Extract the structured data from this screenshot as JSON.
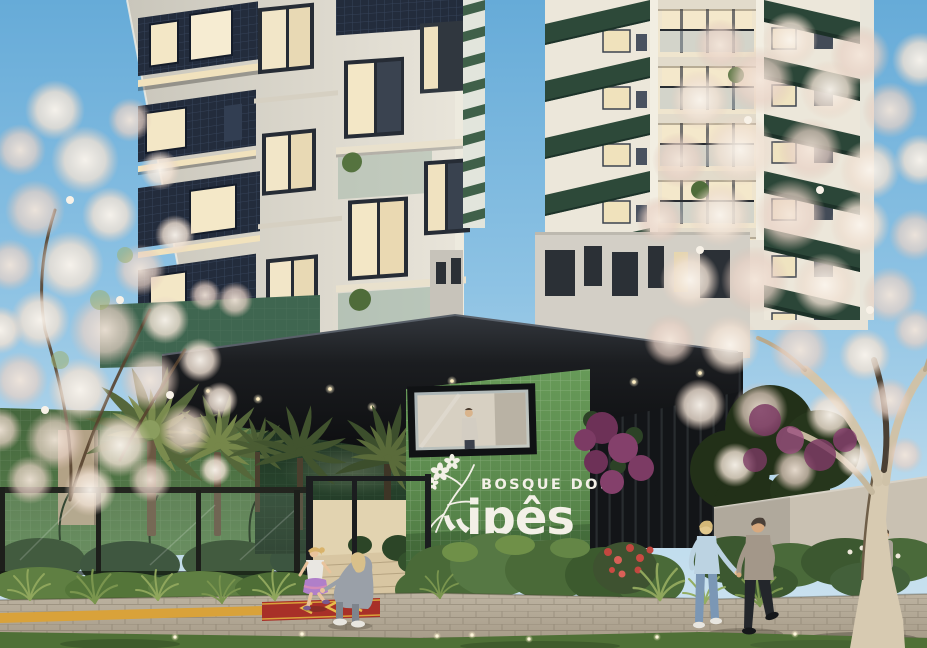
{
  "signage": {
    "line1": "BOSQUE DOS",
    "line2": "ipês"
  },
  "palette": {
    "sky_top": "#66abd8",
    "sky_horizon": "#cfe4f0",
    "canopy_black": "#141619",
    "logo_wall_green": "#5d8c4f",
    "podium_tile_green": "#3f6650",
    "balcony_zigzag_green": "#2d4939",
    "facade_navy_panel": "#232c3c",
    "facade_white": "#e6e2d7",
    "lit_window_warm": "#f3e7c6",
    "blossom_cream": "#f0e1d3",
    "bougainvillea_purple": "#7c3b64",
    "pavement": "#b4aa98",
    "grass": "#55763a",
    "tactile_yellow": "#d9a23a",
    "entrance_mat_red": "#a83028"
  }
}
